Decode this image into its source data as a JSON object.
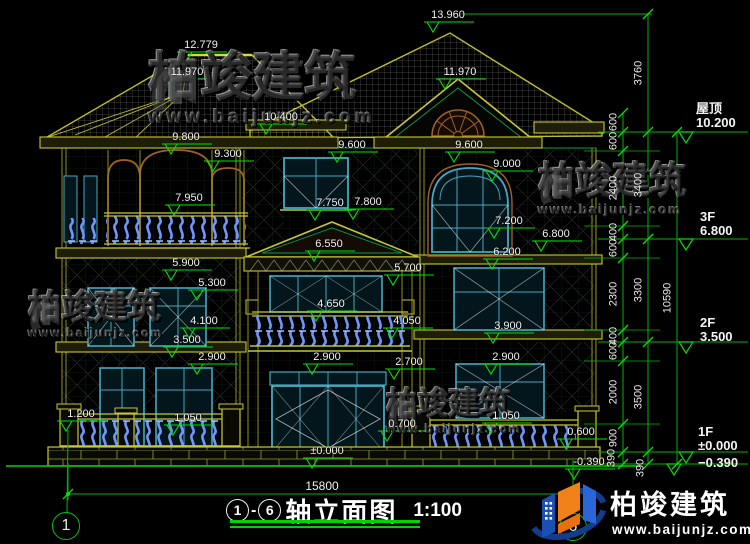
{
  "colors": {
    "background": "#000000",
    "line_green": "#00b400",
    "bright_green": "#00e000",
    "line_yellow": "#bcbc2e",
    "window_cyan": "#46a8c0",
    "baluster_blue": "#6f97ff",
    "arch_brown": "#a06028",
    "text_white": "#f2f2f2"
  },
  "watermark": {
    "brand": "柏竣建筑",
    "url": "www.baijunjz.com"
  },
  "logo": {
    "brand": "柏竣建筑",
    "url": "www.baijunjz.com"
  },
  "drawing": {
    "title": {
      "axis_start": "1",
      "axis_end": "6",
      "dash": "-",
      "name": "轴立面图",
      "scale": "1:100"
    },
    "axis_bubbles": {
      "left": "1",
      "right": "6"
    },
    "overall_width_dim": "15800",
    "levels": [
      {
        "name": "屋顶",
        "value": "10.200",
        "x": 696,
        "y": 102
      },
      {
        "name": "3F",
        "value": "6.800",
        "x": 700,
        "y": 210
      },
      {
        "name": "2F",
        "value": "3.500",
        "x": 700,
        "y": 316
      },
      {
        "name": "1F",
        "value": "±0.000",
        "x": 698,
        "y": 425
      },
      {
        "name": "",
        "value": "−0.390",
        "x": 698,
        "y": 456
      }
    ],
    "elevation_labels": [
      {
        "text": "13.960",
        "x": 448,
        "y": 14
      },
      {
        "text": "12.779",
        "x": 201,
        "y": 44
      },
      {
        "text": "11.970",
        "x": 187,
        "y": 71
      },
      {
        "text": "11.970",
        "x": 460,
        "y": 71
      },
      {
        "text": "10.400",
        "x": 281,
        "y": 116
      },
      {
        "text": "9.800",
        "x": 186,
        "y": 136
      },
      {
        "text": "9.300",
        "x": 228,
        "y": 153
      },
      {
        "text": "9.600",
        "x": 352,
        "y": 144
      },
      {
        "text": "9.600",
        "x": 469,
        "y": 144
      },
      {
        "text": "9.000",
        "x": 507,
        "y": 163
      },
      {
        "text": "7.950",
        "x": 189,
        "y": 197
      },
      {
        "text": "7.750",
        "x": 330,
        "y": 202
      },
      {
        "text": "7.800",
        "x": 368,
        "y": 201
      },
      {
        "text": "7.200",
        "x": 509,
        "y": 220
      },
      {
        "text": "6.800",
        "x": 556,
        "y": 233
      },
      {
        "text": "6.550",
        "x": 329,
        "y": 243
      },
      {
        "text": "6.200",
        "x": 507,
        "y": 251
      },
      {
        "text": "5.900",
        "x": 186,
        "y": 262
      },
      {
        "text": "5.300",
        "x": 212,
        "y": 282
      },
      {
        "text": "5.700",
        "x": 408,
        "y": 267
      },
      {
        "text": "4.650",
        "x": 331,
        "y": 303
      },
      {
        "text": "4.100",
        "x": 204,
        "y": 320
      },
      {
        "text": "4.050",
        "x": 407,
        "y": 320
      },
      {
        "text": "3.900",
        "x": 508,
        "y": 325
      },
      {
        "text": "3.500",
        "x": 187,
        "y": 339
      },
      {
        "text": "2.900",
        "x": 212,
        "y": 356
      },
      {
        "text": "2.900",
        "x": 327,
        "y": 356
      },
      {
        "text": "2.700",
        "x": 409,
        "y": 361
      },
      {
        "text": "2.900",
        "x": 506,
        "y": 356
      },
      {
        "text": "1.200",
        "x": 81,
        "y": 413
      },
      {
        "text": "1.050",
        "x": 188,
        "y": 417
      },
      {
        "text": "1.050",
        "x": 506,
        "y": 415
      },
      {
        "text": "0.700",
        "x": 402,
        "y": 423
      },
      {
        "text": "±0.000",
        "x": 327,
        "y": 450
      },
      {
        "text": "0.600",
        "x": 581,
        "y": 431
      },
      {
        "text": "-0.390",
        "x": 589,
        "y": 461
      }
    ],
    "dim_labels": [
      {
        "text": "600",
        "x": 614,
        "y": 122
      },
      {
        "text": "600",
        "x": 614,
        "y": 141
      },
      {
        "text": "2400",
        "x": 614,
        "y": 188
      },
      {
        "text": "400",
        "x": 614,
        "y": 232
      },
      {
        "text": "600",
        "x": 614,
        "y": 248
      },
      {
        "text": "2300",
        "x": 614,
        "y": 294
      },
      {
        "text": "400",
        "x": 614,
        "y": 336
      },
      {
        "text": "600",
        "x": 614,
        "y": 351
      },
      {
        "text": "2000",
        "x": 614,
        "y": 392
      },
      {
        "text": "900",
        "x": 614,
        "y": 438
      },
      {
        "text": "390",
        "x": 612,
        "y": 458
      },
      {
        "text": "3760",
        "x": 639,
        "y": 73
      },
      {
        "text": "3400",
        "x": 639,
        "y": 185
      },
      {
        "text": "3300",
        "x": 639,
        "y": 290
      },
      {
        "text": "3500",
        "x": 639,
        "y": 397
      },
      {
        "text": "390",
        "x": 641,
        "y": 468
      },
      {
        "text": "10590",
        "x": 668,
        "y": 298
      }
    ],
    "dim_ticks": [
      {
        "x": 623,
        "y": 113
      },
      {
        "x": 623,
        "y": 132
      },
      {
        "x": 623,
        "y": 151
      },
      {
        "x": 623,
        "y": 226
      },
      {
        "x": 623,
        "y": 239
      },
      {
        "x": 623,
        "y": 258
      },
      {
        "x": 623,
        "y": 330
      },
      {
        "x": 623,
        "y": 342
      },
      {
        "x": 623,
        "y": 361
      },
      {
        "x": 623,
        "y": 424
      },
      {
        "x": 623,
        "y": 452
      },
      {
        "x": 623,
        "y": 464
      },
      {
        "x": 648,
        "y": 14
      },
      {
        "x": 648,
        "y": 132
      },
      {
        "x": 648,
        "y": 239
      },
      {
        "x": 648,
        "y": 342
      },
      {
        "x": 648,
        "y": 452
      },
      {
        "x": 648,
        "y": 464
      },
      {
        "x": 677,
        "y": 132
      },
      {
        "x": 677,
        "y": 464
      },
      {
        "x": 68,
        "y": 494
      },
      {
        "x": 573,
        "y": 494
      }
    ]
  }
}
